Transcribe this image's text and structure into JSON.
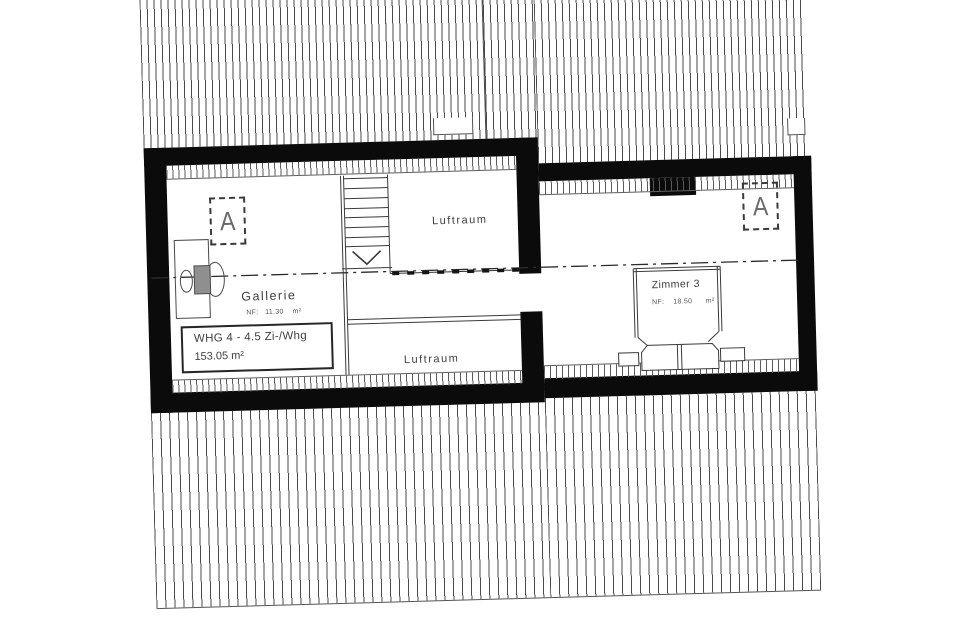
{
  "drawing": {
    "marker_letter": "A",
    "rooms": {
      "gallerie_label": "Gallerie",
      "gallerie_area": "NF:   11.30    m²",
      "luftraum_upper": "Luftraum",
      "luftraum_lower": "Luftraum",
      "zimmer3_label": "Zimmer 3",
      "zimmer3_area": "NF:    18.50      m²"
    },
    "apartment": {
      "line1": "WHG 4 - 4.5 Zi-/Whg",
      "line2": "153.05 m²"
    },
    "colors": {
      "wall": "#0b0b0b",
      "line": "#3a3a3a",
      "text": "#3f3f3f",
      "hatch": "#4a4a4a",
      "background": "#ffffff"
    }
  }
}
